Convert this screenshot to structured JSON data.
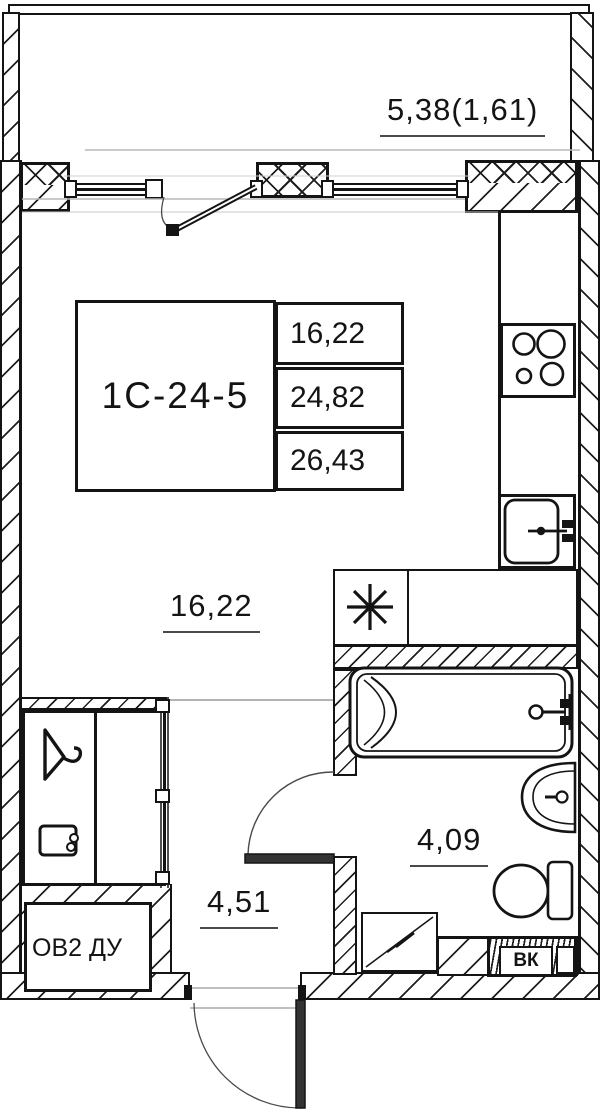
{
  "title": "studio apartment floor plan",
  "info_table": {
    "unit_id": "1С-24-5",
    "areas": [
      "16,22",
      "24,82",
      "26,43"
    ]
  },
  "labels": {
    "balcony": "5,38(1,61)",
    "living_room": "16,22",
    "hallway": "4,51",
    "bathroom": "4,09",
    "vent_shaft": "ОВ2 ДУ",
    "plumbing_shaft": "ВК"
  },
  "colors": {
    "line": "#141414",
    "thin_gray": "#b0b0b0",
    "door_arc": "#4a4a4a",
    "background": "#ffffff"
  },
  "icons": {
    "fridge": "eight-spoke-asterisk",
    "stove": "four-burner-cooktop",
    "kitchen_sink": "single-bowl-sink-with-faucet",
    "bathtub": "bathtub-with-faucet",
    "washbasin": "half-round-basin-with-faucet",
    "toilet": "toilet-with-cistern",
    "washing_machine": "square-with-diagonal",
    "wardrobe_hanger": "clothes-hanger",
    "wardrobe_box": "storage-box",
    "doors": "swing-door-arcs"
  }
}
